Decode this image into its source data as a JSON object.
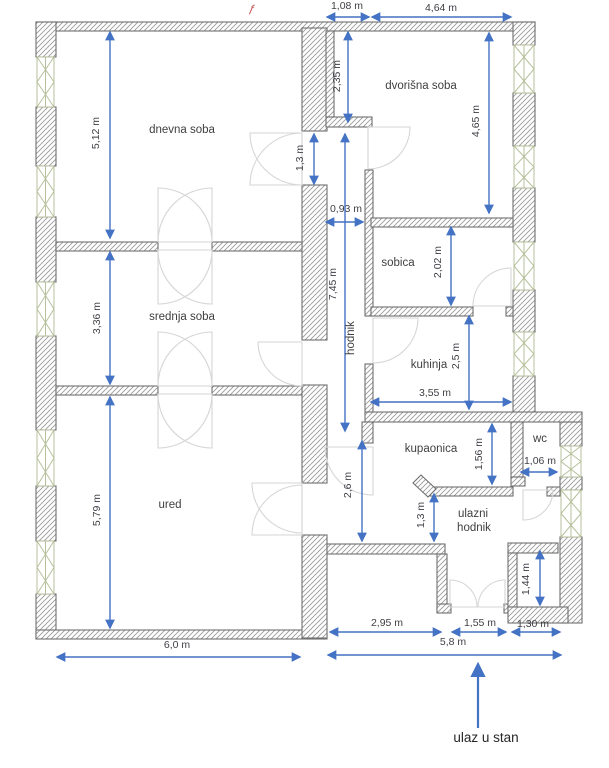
{
  "floorplan": {
    "canvas": {
      "w": 609,
      "h": 768
    },
    "colors": {
      "wall_stroke": "#6f6f6f",
      "hatch_line": "#9b9b9b",
      "window": "#b7c09c",
      "door": "#d6d6d6",
      "dim_line": "#4472c4",
      "dim_text": "#3f3f46",
      "label_text": "#3f3f3f",
      "entrance_text": "#262626",
      "red_mark": "#c0504d"
    },
    "labels": [
      {
        "t": "dnevna soba",
        "x": 182,
        "y": 133,
        "rot": 0
      },
      {
        "t": "srednja soba",
        "x": 182,
        "y": 320,
        "rot": 0
      },
      {
        "t": "ured",
        "x": 170,
        "y": 508,
        "rot": 0
      },
      {
        "t": "dvorišna soba",
        "x": 421,
        "y": 89,
        "rot": 0
      },
      {
        "t": "sobica",
        "x": 398,
        "y": 266,
        "rot": 0
      },
      {
        "t": "kuhinja",
        "x": 429,
        "y": 368,
        "rot": 0
      },
      {
        "t": "hodnik",
        "x": 354,
        "y": 338,
        "rot": 1
      },
      {
        "t": "kupaonica",
        "x": 431,
        "y": 452,
        "rot": 0
      },
      {
        "t": "wc",
        "x": 540,
        "y": 442,
        "rot": 0
      },
      {
        "t": "ulazni",
        "x": 473,
        "y": 517,
        "rot": 0
      },
      {
        "t": "hodnik",
        "x": 474,
        "y": 531,
        "rot": 0
      }
    ],
    "dims": [
      {
        "t": "1,08 m",
        "x": 347,
        "y": 9,
        "rot": 0,
        "l": [
          327,
          17,
          369,
          17
        ]
      },
      {
        "t": "4,64 m",
        "x": 441,
        "y": 11,
        "rot": 0,
        "l": [
          372,
          17,
          511,
          17
        ]
      },
      {
        "t": "5,12 m",
        "x": 99,
        "y": 133,
        "rot": 1,
        "l": [
          110,
          32,
          110,
          238
        ]
      },
      {
        "t": "3,36 m",
        "x": 100,
        "y": 318,
        "rot": 1,
        "l": [
          110,
          252,
          110,
          384
        ]
      },
      {
        "t": "5,79 m",
        "x": 100,
        "y": 510,
        "rot": 1,
        "l": [
          110,
          397,
          110,
          628
        ]
      },
      {
        "t": "2,35 m",
        "x": 340,
        "y": 76,
        "rot": 1,
        "l": [
          348,
          32,
          348,
          122
        ]
      },
      {
        "t": "4,65 m",
        "x": 479,
        "y": 121,
        "rot": 1,
        "l": [
          489,
          33,
          489,
          213
        ]
      },
      {
        "t": "1,3 m",
        "x": 303,
        "y": 158,
        "rot": 1,
        "l": [
          314,
          134,
          314,
          184
        ]
      },
      {
        "t": "0,93 m",
        "x": 346,
        "y": 212,
        "rot": 0,
        "l": [
          326,
          222,
          363,
          222
        ]
      },
      {
        "t": "7,45 m",
        "x": 336,
        "y": 284,
        "rot": 1,
        "l": [
          345,
          134,
          345,
          431
        ]
      },
      {
        "t": "2,02 m",
        "x": 441,
        "y": 262,
        "rot": 1,
        "l": [
          451,
          227,
          451,
          305
        ]
      },
      {
        "t": "2,5 m",
        "x": 459,
        "y": 356,
        "rot": 1,
        "l": [
          469,
          316,
          469,
          409
        ]
      },
      {
        "t": "3,55 m",
        "x": 435,
        "y": 396,
        "rot": 0,
        "l": [
          371,
          402,
          511,
          402
        ]
      },
      {
        "t": "2,6 m",
        "x": 351,
        "y": 485,
        "rot": 1,
        "l": [
          362,
          441,
          362,
          541
        ]
      },
      {
        "t": "1,56 m",
        "x": 482,
        "y": 454,
        "rot": 1,
        "l": [
          492,
          424,
          492,
          484
        ]
      },
      {
        "t": "1,06 m",
        "x": 540,
        "y": 464,
        "rot": 0,
        "l": [
          521,
          472,
          557,
          472
        ]
      },
      {
        "t": "1,3 m",
        "x": 424,
        "y": 515,
        "rot": 1,
        "l": [
          434,
          494,
          434,
          541
        ]
      },
      {
        "t": "1,44 m",
        "x": 529,
        "y": 579,
        "rot": 1,
        "l": [
          540,
          551,
          540,
          605
        ]
      },
      {
        "t": "2,95 m",
        "x": 387,
        "y": 626,
        "rot": 0,
        "l": [
          330,
          632,
          441,
          632
        ]
      },
      {
        "t": "1,55 m",
        "x": 480,
        "y": 626,
        "rot": 0,
        "l": [
          452,
          632,
          506,
          632
        ]
      },
      {
        "t": "1,30 m",
        "x": 533,
        "y": 627,
        "rot": 0,
        "l": [
          512,
          632,
          560,
          632
        ]
      },
      {
        "t": "5,8 m",
        "x": 453,
        "y": 645,
        "rot": 0,
        "l": [
          328,
          655,
          561,
          655
        ]
      },
      {
        "t": "6,0 m",
        "x": 177,
        "y": 648,
        "rot": 0,
        "l": [
          57,
          657,
          300,
          657
        ]
      }
    ],
    "entrance": {
      "label": "ulaz u stan",
      "x": 486,
      "y": 742,
      "arrow": [
        478,
        728,
        478,
        664
      ]
    },
    "red_mark": {
      "glyph": "ƒ",
      "x": 251,
      "y": 12
    },
    "walls": [
      [
        36,
        22,
        499,
        9
      ],
      [
        36,
        22,
        20,
        35
      ],
      [
        36,
        107,
        20,
        59
      ],
      [
        36,
        217,
        20,
        65
      ],
      [
        36,
        336,
        20,
        94
      ],
      [
        36,
        486,
        20,
        55
      ],
      [
        36,
        594,
        20,
        44
      ],
      [
        36,
        630,
        291,
        9
      ],
      [
        513,
        22,
        22,
        23
      ],
      [
        513,
        93,
        22,
        53
      ],
      [
        513,
        188,
        22,
        54
      ],
      [
        513,
        290,
        22,
        42
      ],
      [
        513,
        376,
        22,
        40
      ],
      [
        560,
        422,
        22,
        24
      ],
      [
        560,
        477,
        22,
        13
      ],
      [
        560,
        537,
        22,
        86
      ],
      [
        302,
        28,
        25,
        103
      ],
      [
        302,
        185,
        25,
        155
      ],
      [
        302,
        385,
        25,
        98
      ],
      [
        302,
        535,
        25,
        103
      ],
      [
        326,
        31,
        8,
        86
      ],
      [
        326,
        117,
        46,
        10
      ],
      [
        56,
        242,
        102,
        9
      ],
      [
        212,
        242,
        90,
        9
      ],
      [
        56,
        386,
        102,
        9
      ],
      [
        212,
        386,
        90,
        9
      ],
      [
        365,
        170,
        8,
        146
      ],
      [
        365,
        364,
        8,
        48
      ],
      [
        371,
        218,
        142,
        9
      ],
      [
        371,
        307,
        102,
        9
      ],
      [
        506,
        307,
        7,
        9
      ],
      [
        365,
        412,
        217,
        10
      ],
      [
        362,
        422,
        11,
        21
      ],
      [
        430,
        487,
        83,
        9
      ],
      [
        511,
        422,
        12,
        55
      ],
      [
        511,
        477,
        14,
        9
      ],
      [
        547,
        487,
        13,
        9
      ],
      [
        327,
        544,
        118,
        10
      ],
      [
        437,
        554,
        10,
        58
      ],
      [
        437,
        604,
        14,
        9
      ],
      [
        504,
        604,
        4,
        9
      ],
      [
        508,
        543,
        50,
        10
      ],
      [
        508,
        553,
        9,
        54
      ],
      [
        508,
        607,
        60,
        16
      ]
    ],
    "wall_polys": [
      [
        [
          428,
          497
        ],
        [
          413,
          483
        ],
        [
          421,
          475
        ],
        [
          436,
          489
        ]
      ]
    ],
    "windows": [
      [
        37,
        57,
        17,
        50
      ],
      [
        37,
        166,
        17,
        51
      ],
      [
        37,
        282,
        17,
        54
      ],
      [
        37,
        430,
        17,
        56
      ],
      [
        37,
        541,
        17,
        53
      ],
      [
        514,
        45,
        20,
        48
      ],
      [
        514,
        146,
        20,
        42
      ],
      [
        514,
        242,
        20,
        48
      ],
      [
        514,
        332,
        20,
        44
      ],
      [
        561,
        446,
        20,
        31
      ],
      [
        561,
        490,
        20,
        47
      ]
    ],
    "doors": [
      [
        302,
        133,
        52,
        90,
        180
      ],
      [
        302,
        185,
        52,
        180,
        270
      ],
      [
        158,
        242,
        54,
        270,
        360
      ],
      [
        212,
        242,
        54,
        180,
        270
      ],
      [
        158,
        250,
        54,
        0,
        90
      ],
      [
        212,
        250,
        54,
        90,
        180
      ],
      [
        158,
        386,
        54,
        270,
        360
      ],
      [
        212,
        386,
        54,
        180,
        270
      ],
      [
        158,
        394,
        54,
        0,
        90
      ],
      [
        212,
        394,
        54,
        90,
        180
      ],
      [
        302,
        342,
        44,
        90,
        180
      ],
      [
        302,
        483,
        50,
        90,
        180
      ],
      [
        302,
        535,
        50,
        180,
        270
      ],
      [
        368,
        127,
        42,
        0,
        90
      ],
      [
        511,
        306,
        38,
        180,
        270
      ],
      [
        373,
        318,
        45,
        0,
        90
      ],
      [
        373,
        447,
        48,
        90,
        180
      ],
      [
        523,
        490,
        30,
        0,
        90
      ],
      [
        450,
        607,
        27,
        270,
        360
      ],
      [
        505,
        607,
        27,
        180,
        270
      ]
    ]
  }
}
